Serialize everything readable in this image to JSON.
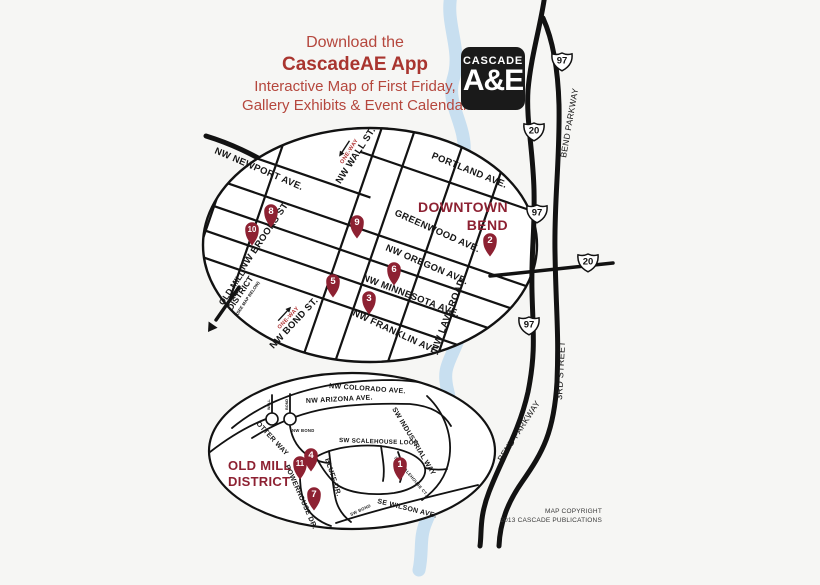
{
  "colors": {
    "background": "#f6f6f4",
    "header_red": "#b5473d",
    "header_red_bold": "#a9352f",
    "map_maroon": "#8d2132",
    "one_way_red": "#b03030",
    "river_blue": "#c8dff0",
    "road_black": "#121212",
    "logo_bg": "#1a1a1a"
  },
  "header": {
    "line1": "Download the",
    "line2": "CascadeAE App",
    "line3": "Interactive Map of First Friday,",
    "line4": "Gallery Exhibits & Event Calendar"
  },
  "logo": {
    "top": "CASCADE",
    "bottom": "A&E"
  },
  "copyright": {
    "line1": "MAP COPYRIGHT",
    "line2": "2013 CASCADE PUBLICATIONS"
  },
  "one_way_label": "ONE-WAY",
  "downtown_map": {
    "title": [
      "DOWNTOWN",
      "BEND"
    ],
    "street_labels": [
      {
        "text": "NW NEWPORT AVE.",
        "x": 214,
        "y": 153,
        "rotate": 23,
        "anchor": "start"
      },
      {
        "text": "PORTLAND AVE.",
        "x": 431,
        "y": 158,
        "rotate": 22,
        "anchor": "start"
      },
      {
        "text": "GREENWOOD AVE.",
        "x": 394,
        "y": 215,
        "rotate": 24,
        "anchor": "start"
      },
      {
        "text": "NW OREGON AVE.",
        "x": 385,
        "y": 250,
        "rotate": 23,
        "anchor": "start"
      },
      {
        "text": "NW MINNESOTA AVE.",
        "x": 362,
        "y": 280,
        "rotate": 21,
        "anchor": "start"
      },
      {
        "text": "NW FRANKLIN AVE.",
        "x": 352,
        "y": 315,
        "rotate": 25,
        "anchor": "start"
      },
      {
        "text": "NW LAVA ROAD",
        "x": 437,
        "y": 352,
        "rotate": -69,
        "anchor": "start"
      },
      {
        "text": "NW WALL ST.",
        "x": 358,
        "y": 157,
        "rotate": -57
      },
      {
        "text": "NW BROOKS ST.",
        "x": 267,
        "y": 237,
        "rotate": -56
      },
      {
        "text": "NW BOND ST.",
        "x": 296,
        "y": 325,
        "rotate": -47
      }
    ],
    "one_ways": [
      {
        "street": "NW WALL ST.",
        "x": 358,
        "y": 157,
        "rotate": -57,
        "dir": "left"
      },
      {
        "street": "NW BOND ST.",
        "x": 296,
        "y": 325,
        "rotate": -47,
        "dir": "right"
      }
    ],
    "district_note": {
      "line1": "OLD MILL",
      "line2": "DISTRICT",
      "line3": "(SEE MAP BELOW)",
      "x": 246,
      "y": 297,
      "rotate": -56
    },
    "markers": [
      {
        "n": "2",
        "x": 490,
        "y": 240
      },
      {
        "n": "3",
        "x": 369,
        "y": 298
      },
      {
        "n": "5",
        "x": 333,
        "y": 281
      },
      {
        "n": "6",
        "x": 394,
        "y": 269
      },
      {
        "n": "8",
        "x": 271,
        "y": 211
      },
      {
        "n": "9",
        "x": 357,
        "y": 222
      },
      {
        "n": "10",
        "x": 252,
        "y": 229
      }
    ]
  },
  "oldmill_map": {
    "title": [
      "OLD MILL",
      "DISTRICT"
    ],
    "street_labels": [
      {
        "text": "NW COLORADO AVE.",
        "x": 329,
        "y": 388,
        "rotate": 4,
        "anchor": "start",
        "size": 7
      },
      {
        "text": "NW ARIZONA AVE.",
        "x": 306,
        "y": 403,
        "rotate": -3,
        "anchor": "start",
        "size": 7
      },
      {
        "text": "SW INDUSTRIAL WAY",
        "x": 392,
        "y": 409,
        "rotate": 59,
        "anchor": "start",
        "size": 7
      },
      {
        "text": "OTTER WAY",
        "x": 256,
        "y": 424,
        "rotate": 47,
        "anchor": "start",
        "size": 7
      },
      {
        "text": "NW BOND",
        "x": 292,
        "y": 432,
        "rotate": 0,
        "anchor": "start",
        "size": 4.2
      },
      {
        "text": "SW SCALEHOUSE LOOP",
        "x": 339,
        "y": 442,
        "rotate": 2,
        "anchor": "start",
        "size": 6.2
      },
      {
        "text": "BLUFF DR.",
        "x": 325,
        "y": 459,
        "rotate": 72,
        "anchor": "start",
        "size": 7
      },
      {
        "text": "POWERHOUSE DR.",
        "x": 285,
        "y": 466,
        "rotate": 66,
        "anchor": "start",
        "size": 7
      },
      {
        "text": "SW SCALEHOUSE CT.",
        "x": 394,
        "y": 458,
        "rotate": 50,
        "anchor": "start",
        "size": 4.2
      },
      {
        "text": "SE WILSON AVE.",
        "x": 377,
        "y": 503,
        "rotate": 14,
        "anchor": "start",
        "size": 7
      },
      {
        "text": "SW BOND",
        "x": 351,
        "y": 516,
        "rotate": -25,
        "anchor": "start",
        "size": 4.2
      }
    ],
    "roundabouts": [
      {
        "label": "WALL",
        "x": 272,
        "y": 419
      },
      {
        "label": "BOND",
        "x": 290,
        "y": 419
      }
    ],
    "markers": [
      {
        "n": "1",
        "x": 400,
        "y": 464
      },
      {
        "n": "4",
        "x": 311,
        "y": 455
      },
      {
        "n": "7",
        "x": 314,
        "y": 494
      },
      {
        "n": "11",
        "x": 300,
        "y": 463
      }
    ]
  },
  "highways": {
    "shields": [
      {
        "route": "97",
        "x": 562,
        "y": 60
      },
      {
        "route": "20",
        "x": 534,
        "y": 130
      },
      {
        "route": "97",
        "x": 537,
        "y": 212
      },
      {
        "route": "20",
        "x": 588,
        "y": 261
      },
      {
        "route": "97",
        "x": 529,
        "y": 324
      }
    ],
    "labels": [
      {
        "text": "BEND PARKWAY",
        "x": 566,
        "y": 158,
        "rotate": -80,
        "anchor": "start",
        "size": 8.5
      },
      {
        "text": "3RD STREET",
        "x": 562,
        "y": 400,
        "rotate": -87,
        "anchor": "start",
        "size": 9
      },
      {
        "text": "BEND PARKWAY",
        "x": 502,
        "y": 462,
        "rotate": -57,
        "anchor": "start",
        "size": 8.5
      }
    ]
  }
}
